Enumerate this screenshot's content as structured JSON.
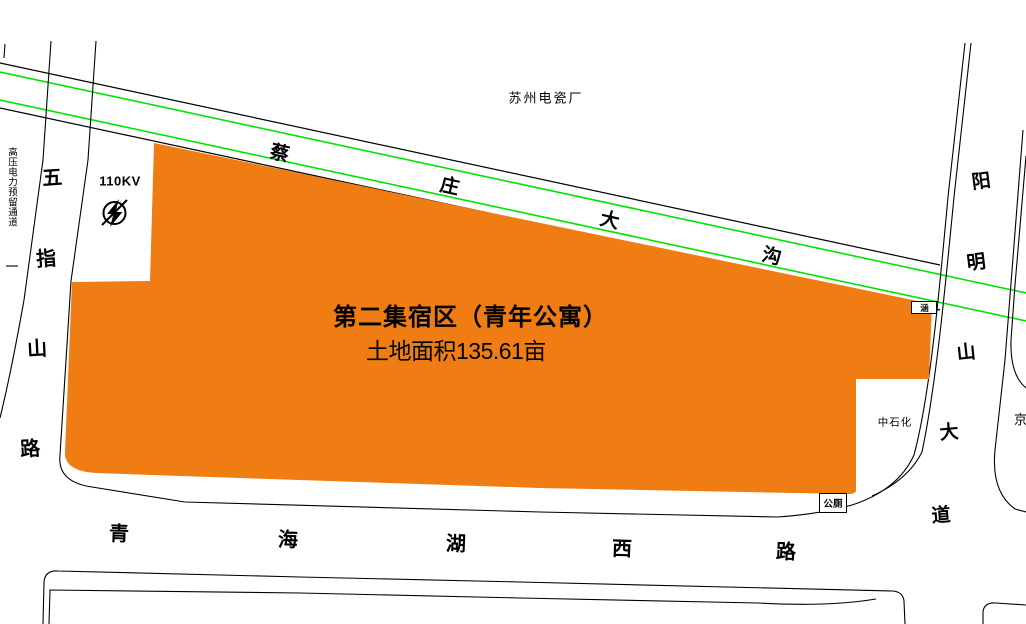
{
  "canvas": {
    "width": 1026,
    "height": 624,
    "background": "#ffffff"
  },
  "colors": {
    "parcel_orange": "#F07D14",
    "channel_green": "#00E400",
    "line_black": "#000000"
  },
  "parcel": {
    "title": "第二集宿区（青年公寓）",
    "area_label": "土地面积135.61亩"
  },
  "landmarks": {
    "factory": "苏州电瓷厂",
    "power_corridor": "高压电力预留通道",
    "power_voltage": "110KV",
    "sinopec": "中石化",
    "public_toilet": "公厕",
    "culvert_marker": "涵",
    "edge_partial_label": "京"
  },
  "roads": {
    "caizhuang_ditch": {
      "name": "蔡庄大沟",
      "chars": [
        "蔡",
        "庄",
        "大",
        "沟"
      ]
    },
    "wuzhishan_road": {
      "name": "五指山路",
      "chars": [
        "五",
        "指",
        "山",
        "路"
      ]
    },
    "qinghaihu_west_road": {
      "name": "青海湖西路",
      "chars": [
        "青",
        "海",
        "湖",
        "西",
        "路"
      ]
    },
    "yangmingshan_avenue": {
      "name": "阳明山大道",
      "chars": [
        "阳",
        "明",
        "山",
        "大",
        "道"
      ]
    }
  }
}
